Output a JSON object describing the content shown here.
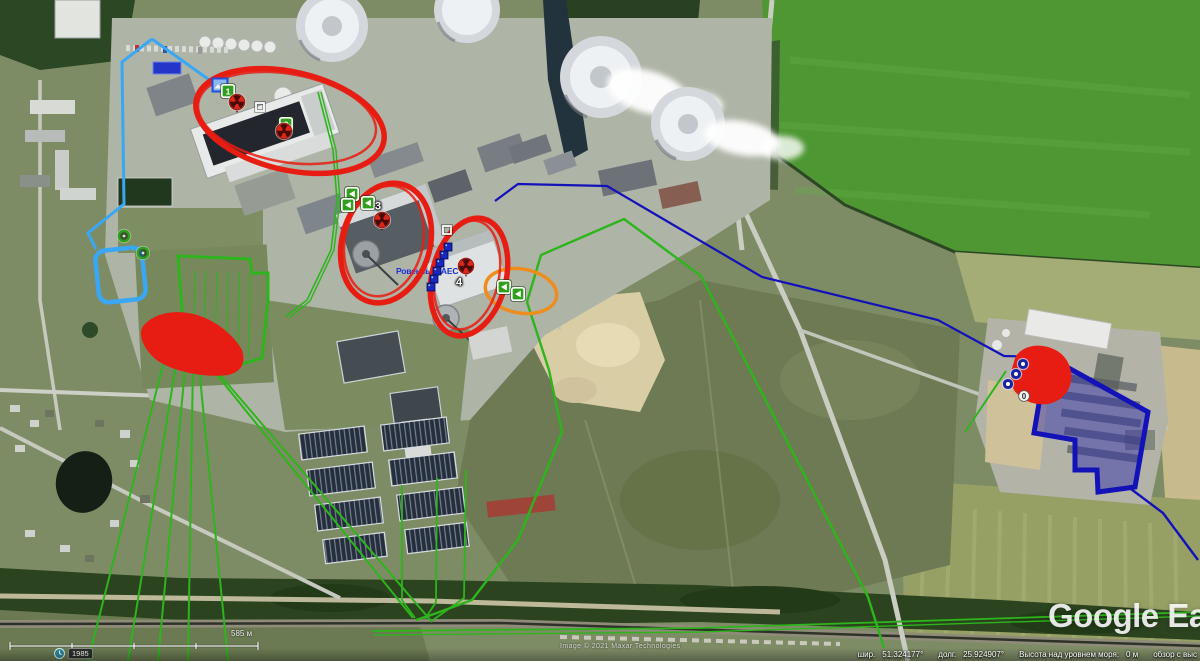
{
  "map": {
    "location_label": "Ровенська АЕС"
  },
  "chrome": {
    "watermark": "Google Earth",
    "attribution": "Image © 2021 Maxar Technologies",
    "history_year": "1985",
    "scale_label": "585 м",
    "status": {
      "lat_label": "шир.",
      "lat_value": "51.324177°",
      "lon_label": "долг.",
      "lon_value": "25.924907°",
      "elevation_label": "Высота над уровнем моря:",
      "elevation_value": "0 м",
      "view_label": "обзор с выс"
    }
  },
  "colors": {
    "annotation_red": "#e71d13",
    "annotation_green": "#2eb41c",
    "annotation_light_blue": "#3aa7f5",
    "annotation_navy": "#1212b8",
    "area_fill_navy": "rgba(40,40,175,0.45)",
    "annotation_orange": "#ee8c1d",
    "label_blue": "#1b2fd0"
  },
  "markers": [
    {
      "type": "photo-blue",
      "x": 220,
      "y": 85
    },
    {
      "type": "green-number",
      "x": 228,
      "y": 91,
      "label": "1"
    },
    {
      "type": "red-trefoil",
      "x": 237,
      "y": 104
    },
    {
      "type": "white-square",
      "x": 260,
      "y": 107
    },
    {
      "type": "green-number",
      "x": 286,
      "y": 124,
      "label": "2"
    },
    {
      "type": "red-trefoil",
      "x": 284,
      "y": 133
    },
    {
      "type": "green-arrow",
      "x": 352,
      "y": 194
    },
    {
      "type": "green-arrow",
      "x": 348,
      "y": 205
    },
    {
      "type": "green-arrow",
      "x": 368,
      "y": 203
    },
    {
      "type": "label",
      "x": 378,
      "y": 207,
      "label": "3"
    },
    {
      "type": "red-trefoil",
      "x": 382,
      "y": 222
    },
    {
      "type": "white-square",
      "x": 447,
      "y": 230
    },
    {
      "type": "red-trefoil",
      "x": 466,
      "y": 268
    },
    {
      "type": "label",
      "x": 459,
      "y": 283,
      "label": "4"
    },
    {
      "type": "green-arrow",
      "x": 504,
      "y": 287
    },
    {
      "type": "green-arrow",
      "x": 518,
      "y": 294
    },
    {
      "type": "green-donut",
      "x": 124,
      "y": 236
    },
    {
      "type": "green-donut",
      "x": 143,
      "y": 253
    },
    {
      "type": "blue-donut",
      "x": 1023,
      "y": 364
    },
    {
      "type": "blue-donut",
      "x": 1016,
      "y": 374
    },
    {
      "type": "blue-donut",
      "x": 1008,
      "y": 384
    },
    {
      "type": "white-circle",
      "x": 1024,
      "y": 396,
      "label": "0"
    },
    {
      "type": "navy-square",
      "x": 448,
      "y": 247
    },
    {
      "type": "navy-square",
      "x": 444,
      "y": 255
    },
    {
      "type": "navy-square",
      "x": 440,
      "y": 263
    },
    {
      "type": "navy-square",
      "x": 437,
      "y": 271
    },
    {
      "type": "navy-square",
      "x": 434,
      "y": 279
    },
    {
      "type": "navy-square",
      "x": 431,
      "y": 287
    }
  ]
}
